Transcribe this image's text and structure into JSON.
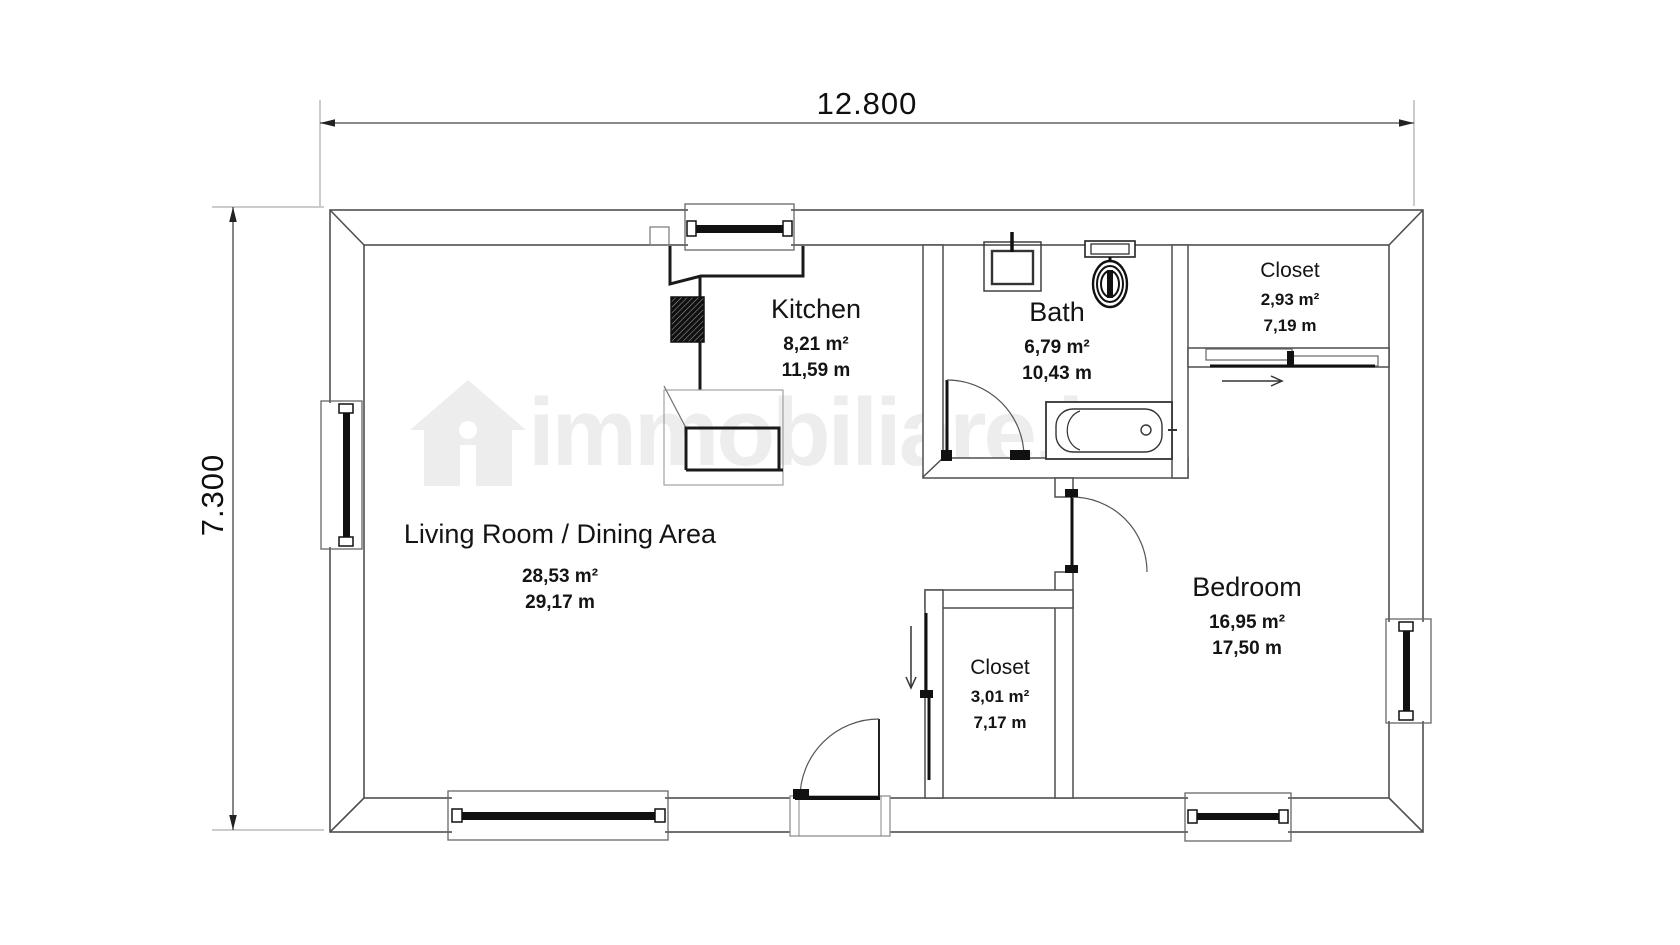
{
  "dimensions": {
    "width_label": "12.800",
    "height_label": "7.300"
  },
  "rooms": {
    "kitchen": {
      "name": "Kitchen",
      "area": "8,21 m²",
      "perimeter": "11,59 m"
    },
    "bath": {
      "name": "Bath",
      "area": "6,79 m²",
      "perimeter": "10,43 m"
    },
    "closet_top": {
      "name": "Closet",
      "area": "2,93 m²",
      "perimeter": "7,19 m"
    },
    "living": {
      "name": "Living Room / Dining Area",
      "area": "28,53 m²",
      "perimeter": "29,17 m"
    },
    "bedroom": {
      "name": "Bedroom",
      "area": "16,95 m²",
      "perimeter": "17,50 m"
    },
    "closet_bottom": {
      "name": "Closet",
      "area": "3,01 m²",
      "perimeter": "7,17 m"
    }
  },
  "watermark": {
    "text": "immobiliare.it"
  },
  "colors": {
    "wall_line": "#4f4f4f",
    "thin_line": "#777777",
    "dark": "#111111",
    "text": "#141414",
    "watermark": "#9a9a9a"
  }
}
